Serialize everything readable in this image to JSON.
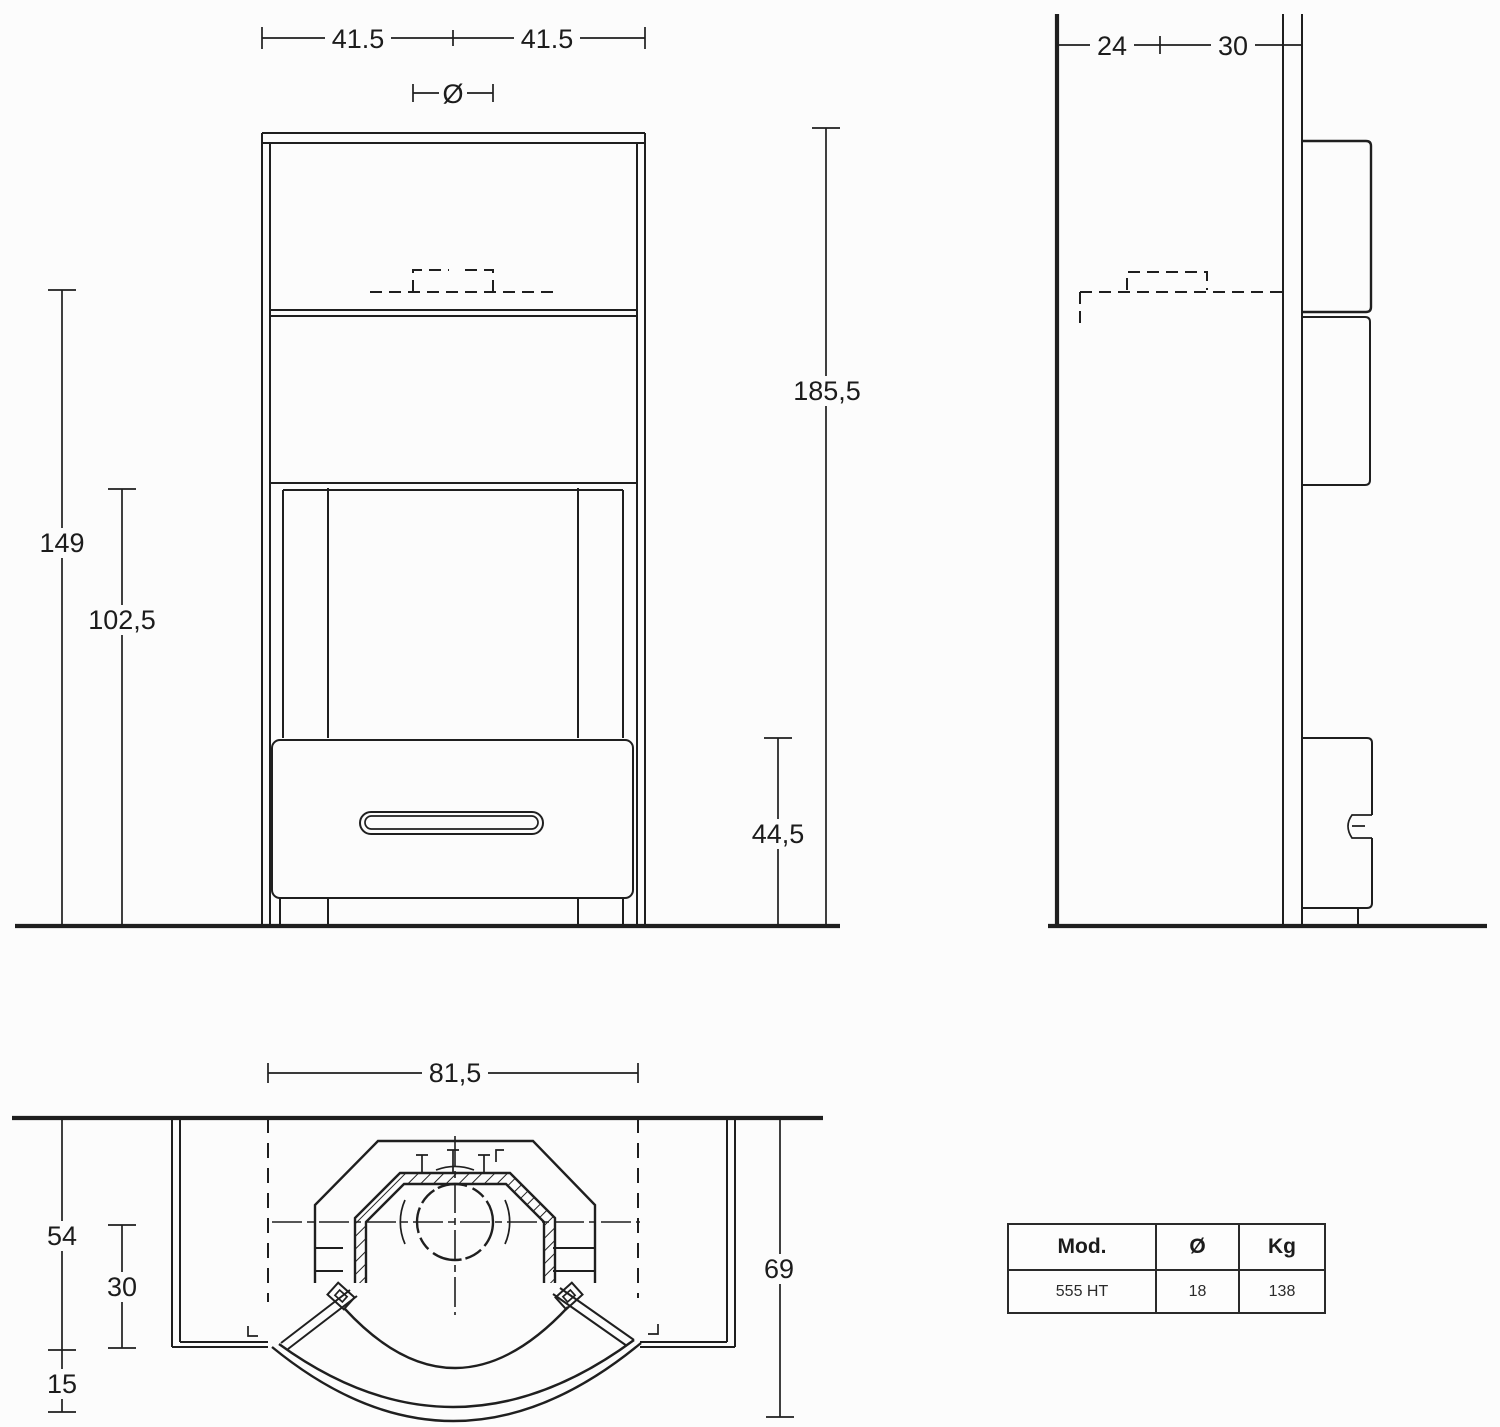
{
  "colors": {
    "ink": "#1f1f1f",
    "background": "#fcfcfc"
  },
  "front_view": {
    "dim_top_left": "41.5",
    "dim_top_right": "41.5",
    "flue_symbol": "Ø",
    "height_total": "185,5",
    "height_flue": "149",
    "height_opening": "102,5",
    "height_base": "44,5"
  },
  "side_view": {
    "wall_distance": "24",
    "body_depth": "30"
  },
  "plan_view": {
    "top_width": "81,5",
    "body_depth": "54",
    "inner_depth": "30",
    "door_offset": "15",
    "total_depth": "69"
  },
  "spec_table": {
    "col_mod": "Mod.",
    "col_diameter": "Ø",
    "col_weight": "Kg",
    "row": {
      "mod": "555 HT",
      "diameter": "18",
      "weight": "138"
    }
  }
}
